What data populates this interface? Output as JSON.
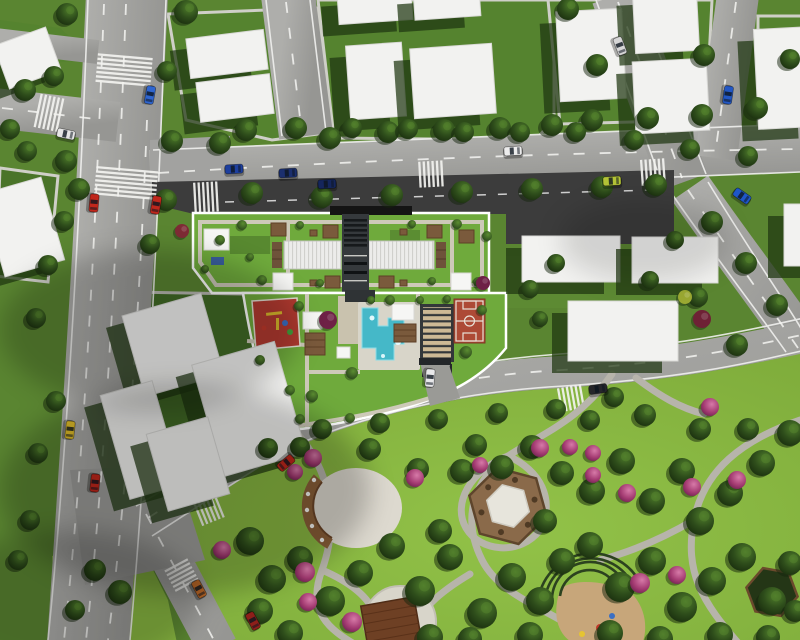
{
  "meta": {
    "title": "Aerial 3D site plan render of residential block with roof garden, pool, sports court and public park",
    "view": "top-down axonometric render",
    "visible_text": "none"
  },
  "palette": {
    "grass": "#5a8531",
    "lot_grass": "#55832f",
    "shadow_lot": "#426b26",
    "park_green": "#88b640",
    "road_gray": "#a4a4a1",
    "asphalt_dark": "#3c3c3c",
    "building_white": "#f2f2f0",
    "building_shadow": "#1e3610",
    "roof_garden_green": "#6faa3c",
    "path_tan": "#cdc9b8",
    "pool_blue": "#45b8c8",
    "court_red": "#ad4a36",
    "playground_red": "#b23a30",
    "wood_brown": "#7a5a3c",
    "amphitheater_tan": "#cdb995",
    "pink_tree": "#c2588c",
    "tree_dark_green": "#2a4519",
    "marking_white": "#f2f2ef"
  },
  "scene": {
    "amenity_labels": [
      "roof-garden",
      "skylight-roof",
      "service-core",
      "pergola",
      "sun-canopy",
      "swimming-pool",
      "sun-deck",
      "amphitheater-steps",
      "basketball-court",
      "children-playground",
      "entrance-drive",
      "park-gazebo",
      "park-plaza-stage",
      "curved-bench-pergola",
      "trellis-playground",
      "shade-structure"
    ],
    "buildings": [
      [
        0,
        35,
        55,
        46,
        -20
      ],
      [
        188,
        34,
        78,
        40,
        -7
      ],
      [
        198,
        78,
        74,
        40,
        -7
      ],
      [
        338,
        -8,
        74,
        30,
        -4
      ],
      [
        414,
        -10,
        66,
        28,
        -4
      ],
      [
        348,
        44,
        56,
        74,
        -4
      ],
      [
        412,
        46,
        82,
        70,
        -4
      ],
      [
        558,
        10,
        66,
        90,
        -3
      ],
      [
        634,
        -8,
        64,
        60,
        -3
      ],
      [
        634,
        60,
        74,
        72,
        -3
      ],
      [
        756,
        28,
        56,
        100,
        -3
      ],
      [
        522,
        236,
        98,
        46,
        0
      ],
      [
        632,
        237,
        86,
        46,
        0
      ],
      [
        568,
        301,
        110,
        60,
        0
      ],
      [
        784,
        204,
        40,
        62,
        0
      ],
      [
        -8,
        184,
        62,
        86,
        -16
      ],
      [
        132,
        303,
        82,
        84,
        -16
      ],
      [
        114,
        386,
        54,
        108,
        -16
      ],
      [
        206,
        351,
        86,
        116,
        -16
      ],
      [
        156,
        424,
        64,
        80,
        -16
      ]
    ],
    "trees": [
      [
        67,
        14,
        11
      ],
      [
        186,
        12,
        12
      ],
      [
        25,
        90,
        11
      ],
      [
        54,
        76,
        10
      ],
      [
        10,
        129,
        10
      ],
      [
        27,
        151,
        10
      ],
      [
        66,
        161,
        11
      ],
      [
        79,
        189,
        11
      ],
      [
        167,
        71,
        10
      ],
      [
        172,
        141,
        11
      ],
      [
        220,
        143,
        11
      ],
      [
        330,
        138,
        11
      ],
      [
        388,
        132,
        11
      ],
      [
        444,
        130,
        11
      ],
      [
        500,
        128,
        11
      ],
      [
        552,
        125,
        11
      ],
      [
        568,
        9,
        11
      ],
      [
        597,
        65,
        11
      ],
      [
        592,
        120,
        11
      ],
      [
        648,
        118,
        11
      ],
      [
        704,
        55,
        11
      ],
      [
        702,
        115,
        11
      ],
      [
        757,
        108,
        11
      ],
      [
        790,
        59,
        10
      ],
      [
        246,
        130,
        11
      ],
      [
        296,
        128,
        11
      ],
      [
        352,
        128,
        10
      ],
      [
        408,
        129,
        10
      ],
      [
        464,
        132,
        10
      ],
      [
        520,
        132,
        10
      ],
      [
        576,
        132,
        10
      ],
      [
        634,
        140,
        10
      ],
      [
        690,
        149,
        10
      ],
      [
        748,
        156,
        10
      ],
      [
        166,
        200,
        11
      ],
      [
        252,
        193,
        11
      ],
      [
        322,
        197,
        11
      ],
      [
        392,
        195,
        11
      ],
      [
        462,
        192,
        11
      ],
      [
        532,
        189,
        11
      ],
      [
        602,
        187,
        11
      ],
      [
        656,
        185,
        11
      ],
      [
        712,
        222,
        11
      ],
      [
        746,
        263,
        11
      ],
      [
        777,
        305,
        11
      ],
      [
        698,
        297,
        10
      ],
      [
        737,
        345,
        11
      ],
      [
        64,
        221,
        10
      ],
      [
        48,
        265,
        10
      ],
      [
        36,
        318,
        10
      ],
      [
        56,
        401,
        10
      ],
      [
        38,
        453,
        10
      ],
      [
        150,
        244,
        10
      ],
      [
        322,
        429,
        10
      ],
      [
        380,
        423,
        10
      ],
      [
        438,
        419,
        10
      ],
      [
        498,
        413,
        10
      ],
      [
        556,
        409,
        10
      ],
      [
        614,
        397,
        10
      ],
      [
        268,
        448,
        10
      ],
      [
        530,
        289,
        9
      ],
      [
        556,
        263,
        9
      ],
      [
        540,
        319,
        8
      ],
      [
        675,
        240,
        9
      ],
      [
        650,
        280,
        9
      ],
      [
        95,
        570,
        11
      ],
      [
        120,
        592,
        12
      ],
      [
        75,
        610,
        10
      ],
      [
        30,
        520,
        10
      ],
      [
        18,
        560,
        10
      ],
      [
        250,
        541,
        14
      ],
      [
        272,
        579,
        14
      ],
      [
        300,
        559,
        13
      ],
      [
        330,
        601,
        15
      ],
      [
        360,
        573,
        13
      ],
      [
        392,
        546,
        13
      ],
      [
        420,
        591,
        15
      ],
      [
        450,
        557,
        13
      ],
      [
        482,
        613,
        15
      ],
      [
        512,
        577,
        14
      ],
      [
        540,
        601,
        14
      ],
      [
        562,
        561,
        13
      ],
      [
        590,
        545,
        13
      ],
      [
        620,
        587,
        15
      ],
      [
        652,
        561,
        14
      ],
      [
        682,
        607,
        15
      ],
      [
        712,
        581,
        14
      ],
      [
        742,
        557,
        14
      ],
      [
        772,
        601,
        14
      ],
      [
        790,
        563,
        12
      ],
      [
        700,
        521,
        14
      ],
      [
        730,
        493,
        13
      ],
      [
        762,
        463,
        13
      ],
      [
        790,
        433,
        13
      ],
      [
        682,
        471,
        13
      ],
      [
        652,
        501,
        13
      ],
      [
        622,
        461,
        13
      ],
      [
        592,
        491,
        13
      ],
      [
        562,
        473,
        12
      ],
      [
        532,
        447,
        12
      ],
      [
        502,
        467,
        12
      ],
      [
        462,
        471,
        12
      ],
      [
        476,
        445,
        11
      ],
      [
        545,
        521,
        12
      ],
      [
        440,
        531,
        12
      ],
      [
        370,
        449,
        11
      ],
      [
        418,
        469,
        11
      ],
      [
        300,
        447,
        10
      ],
      [
        260,
        611,
        13
      ],
      [
        290,
        633,
        13
      ],
      [
        430,
        637,
        13
      ],
      [
        470,
        639,
        12
      ],
      [
        530,
        635,
        13
      ],
      [
        610,
        633,
        13
      ],
      [
        660,
        639,
        13
      ],
      [
        720,
        635,
        13
      ],
      [
        768,
        637,
        12
      ],
      [
        795,
        611,
        11
      ],
      [
        700,
        429,
        11
      ],
      [
        748,
        429,
        11
      ],
      [
        645,
        415,
        11
      ],
      [
        590,
        420,
        10
      ]
    ],
    "pink_trees": [
      [
        313,
        458,
        9
      ],
      [
        415,
        478,
        9
      ],
      [
        305,
        572,
        10
      ],
      [
        308,
        602,
        9
      ],
      [
        352,
        622,
        10
      ],
      [
        540,
        448,
        9
      ],
      [
        570,
        447,
        8
      ],
      [
        593,
        453,
        8
      ],
      [
        480,
        465,
        8
      ],
      [
        593,
        475,
        8
      ],
      [
        627,
        493,
        9
      ],
      [
        640,
        583,
        10
      ],
      [
        677,
        575,
        9
      ],
      [
        710,
        407,
        9
      ],
      [
        692,
        487,
        9
      ],
      [
        737,
        480,
        9
      ],
      [
        222,
        550,
        9
      ],
      [
        295,
        472,
        8
      ]
    ],
    "bushes": [
      [
        220,
        240,
        5
      ],
      [
        242,
        225,
        5
      ],
      [
        262,
        280,
        5
      ],
      [
        300,
        225,
        4
      ],
      [
        320,
        283,
        4
      ],
      [
        412,
        224,
        4
      ],
      [
        432,
        281,
        4
      ],
      [
        457,
        224,
        5
      ],
      [
        478,
        282,
        5
      ],
      [
        205,
        269,
        4
      ],
      [
        487,
        236,
        5
      ],
      [
        250,
        257,
        4
      ],
      [
        299,
        306,
        5
      ],
      [
        312,
        396,
        6
      ],
      [
        352,
        373,
        6
      ],
      [
        390,
        300,
        5
      ],
      [
        466,
        352,
        6
      ],
      [
        482,
        310,
        5
      ],
      [
        350,
        418,
        5
      ],
      [
        300,
        419,
        5
      ],
      [
        371,
        300,
        4
      ],
      [
        447,
        299,
        4
      ],
      [
        420,
        300,
        4
      ],
      [
        260,
        360,
        5
      ],
      [
        290,
        390,
        5
      ]
    ],
    "accent_bushes": [
      {
        "x": 328,
        "y": 320,
        "r": 9,
        "color": "#6e2146"
      },
      {
        "x": 483,
        "y": 283,
        "r": 7,
        "color": "#6e2146"
      },
      {
        "x": 182,
        "y": 231,
        "r": 7,
        "color": "#7e2b35"
      },
      {
        "x": 702,
        "y": 319,
        "r": 9,
        "color": "#6e2135"
      },
      {
        "x": 685,
        "y": 297,
        "r": 7,
        "color": "#9aa832"
      }
    ],
    "cars": [
      {
        "x": 150,
        "y": 95,
        "angle": 100,
        "color": "#2f66d0"
      },
      {
        "x": 66,
        "y": 134,
        "angle": 12,
        "color": "#e6e6e6"
      },
      {
        "x": 94,
        "y": 203,
        "angle": 95,
        "color": "#c0271c"
      },
      {
        "x": 156,
        "y": 205,
        "angle": 100,
        "color": "#c0271c"
      },
      {
        "x": 234,
        "y": 169,
        "angle": -3,
        "color": "#1d3f9e"
      },
      {
        "x": 288,
        "y": 173,
        "angle": -3,
        "color": "#1b2f6e"
      },
      {
        "x": 327,
        "y": 184,
        "angle": -3,
        "color": "#15265c"
      },
      {
        "x": 513,
        "y": 151,
        "angle": -3,
        "color": "#ececec"
      },
      {
        "x": 612,
        "y": 181,
        "angle": -3,
        "color": "#b4c437"
      },
      {
        "x": 742,
        "y": 196,
        "angle": 35,
        "color": "#1f57c8"
      },
      {
        "x": 620,
        "y": 46,
        "angle": 69,
        "color": "#d6d6d6"
      },
      {
        "x": 728,
        "y": 95,
        "angle": 98,
        "color": "#2257c4"
      },
      {
        "x": 70,
        "y": 430,
        "angle": 96,
        "color": "#e2bf2a"
      },
      {
        "x": 95,
        "y": 483,
        "angle": 96,
        "color": "#c0271c"
      },
      {
        "x": 199,
        "y": 589,
        "angle": 62,
        "color": "#bf6a28"
      },
      {
        "x": 286,
        "y": 463,
        "angle": 140,
        "color": "#c0271c"
      },
      {
        "x": 253,
        "y": 621,
        "angle": 62,
        "color": "#8e1f1a"
      },
      {
        "x": 598,
        "y": 389,
        "angle": -8,
        "color": "#26262a"
      },
      {
        "x": 430,
        "y": 378,
        "angle": 95,
        "color": "#e8e8ea"
      }
    ],
    "crosswalks": [
      {
        "x": 124,
        "y": 71,
        "angle": 95,
        "len": 55,
        "count": 7
      },
      {
        "x": 50,
        "y": 113,
        "angle": 12,
        "len": 34,
        "count": 6
      },
      {
        "x": 126,
        "y": 184,
        "angle": 95,
        "len": 62,
        "count": 7
      },
      {
        "x": 207,
        "y": 197,
        "angle": -3,
        "len": 30,
        "count": 6
      },
      {
        "x": 432,
        "y": 174,
        "angle": -3,
        "len": 26,
        "count": 6
      },
      {
        "x": 654,
        "y": 172,
        "angle": -4,
        "len": 26,
        "count": 6
      },
      {
        "x": 572,
        "y": 398,
        "angle": -10,
        "len": 24,
        "count": 6
      },
      {
        "x": 210,
        "y": 510,
        "angle": -22,
        "len": 24,
        "count": 6
      },
      {
        "x": 182,
        "y": 576,
        "angle": 62,
        "len": 26,
        "count": 6
      }
    ]
  }
}
